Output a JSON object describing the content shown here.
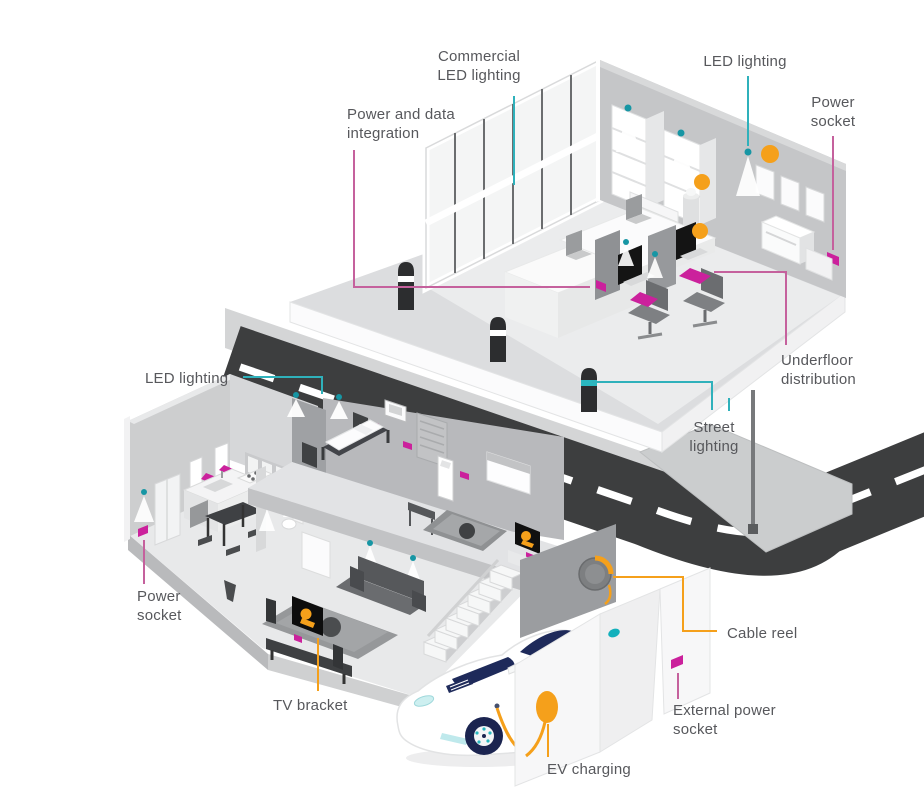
{
  "palette": {
    "accent_teal": "#2fb1bb",
    "accent_magenta": "#cb219c",
    "leader_pink": "#c5619d",
    "accent_orange": "#f5a01b",
    "road_gray": "#3d3e3f",
    "label_text": "#57585c",
    "wall_gray": "#c5c6c8",
    "car_window_navy": "#1e2a5a"
  },
  "labels": [
    {
      "id": "commercial-led-lighting",
      "text": "Commercial\nLED lighting",
      "line_color": "#2fb1bb"
    },
    {
      "id": "led-lighting-office",
      "text": "LED lighting",
      "line_color": "#2fb1bb"
    },
    {
      "id": "power-socket-office",
      "text": "Power\nsocket",
      "line_color": "#c5619d"
    },
    {
      "id": "power-and-data-integration",
      "text": "Power and data\nintegration",
      "line_color": "#c5619d"
    },
    {
      "id": "underfloor-distribution",
      "text": "Underfloor\ndistribution",
      "line_color": "#c5619d"
    },
    {
      "id": "led-lighting-house",
      "text": "LED lighting",
      "line_color": "#2fb1bb"
    },
    {
      "id": "power-socket-house",
      "text": "Power\nsocket",
      "line_color": "#c5619d"
    },
    {
      "id": "street-lighting",
      "text": "Street\nlighting",
      "line_color": "#2fb1bb"
    },
    {
      "id": "cable-reel",
      "text": "Cable reel",
      "line_color": "#f5a01b"
    },
    {
      "id": "external-power-socket",
      "text": "External power\nsocket",
      "line_color": "#c5619d"
    },
    {
      "id": "tv-bracket",
      "text": "TV bracket",
      "line_color": "#f5a01b"
    },
    {
      "id": "ev-charging",
      "text": "EV charging",
      "line_color": "#f5a01b"
    }
  ]
}
